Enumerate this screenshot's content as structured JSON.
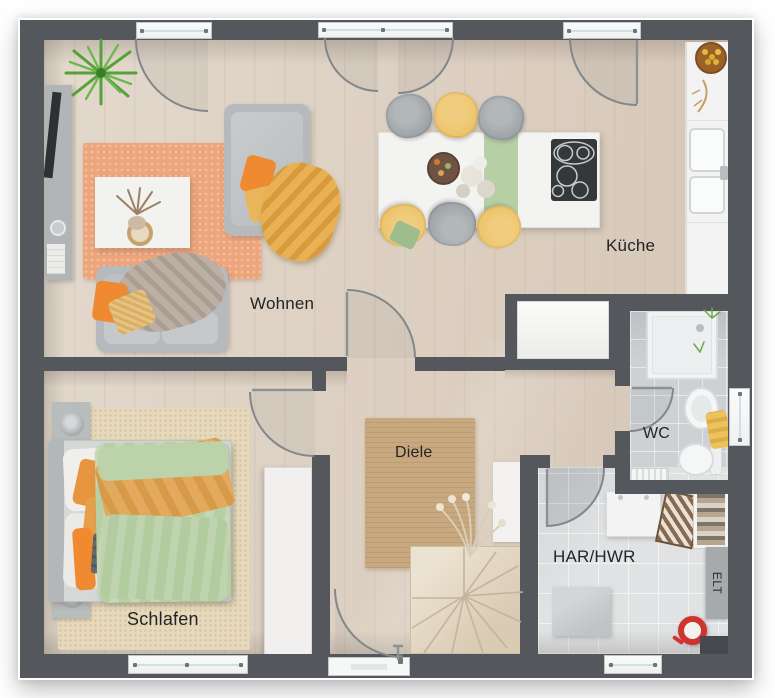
{
  "rooms": {
    "wohnen": {
      "label": "Wohnen"
    },
    "kueche": {
      "label": "Küche"
    },
    "diele": {
      "label": "Diele"
    },
    "schlafen": {
      "label": "Schlafen"
    },
    "wc": {
      "label": "WC"
    },
    "har_hwr": {
      "label": "HAR/HWR"
    },
    "elt": {
      "label": "ELT"
    }
  },
  "palette": {
    "wall": "#54585c",
    "wood_floor": "#dccfc0",
    "tile_wc": "#cdd1d4",
    "tile_har": "#e0e2e3",
    "rug_living": "#eda57b",
    "rug_hall": "#c8a87e",
    "rug_bed": "#e7d9bb",
    "accent_orange": "#ef8a30",
    "accent_yellow": "#e9b65b",
    "accent_green": "#b7cfa5",
    "sofa_gray": "#b7babc",
    "chair_yellow": "#ecc268",
    "label_color": "#222426"
  }
}
